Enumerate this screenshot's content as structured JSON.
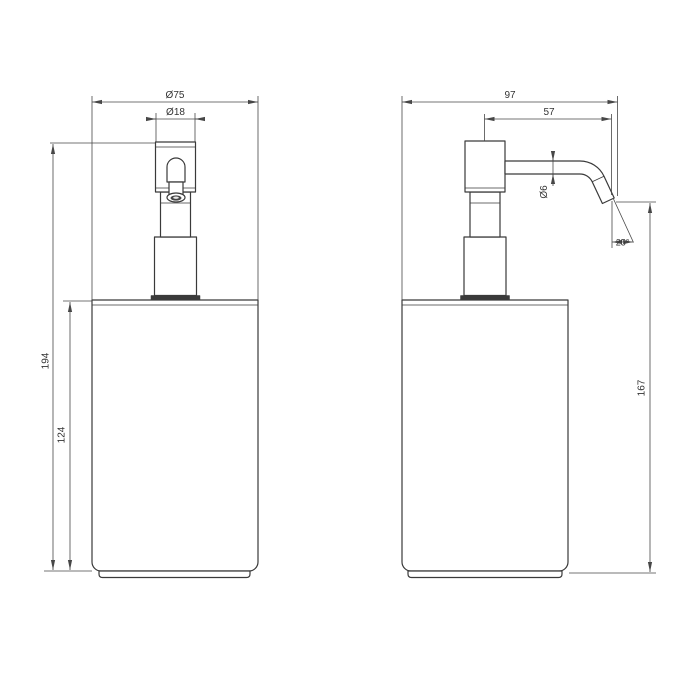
{
  "front_view": {
    "label_dia_body": "Ø75",
    "label_dia_pump": "Ø18",
    "label_height_total": "194",
    "label_height_body": "124"
  },
  "side_view": {
    "label_depth_total": "97",
    "label_spout_reach": "57",
    "label_spout_dia": "Ø6",
    "label_spout_angle": "25°",
    "label_height_spout": "167"
  },
  "colors": {
    "line": "#3a3a3a",
    "dim": "#474747",
    "text": "#333333",
    "background": "#ffffff"
  }
}
